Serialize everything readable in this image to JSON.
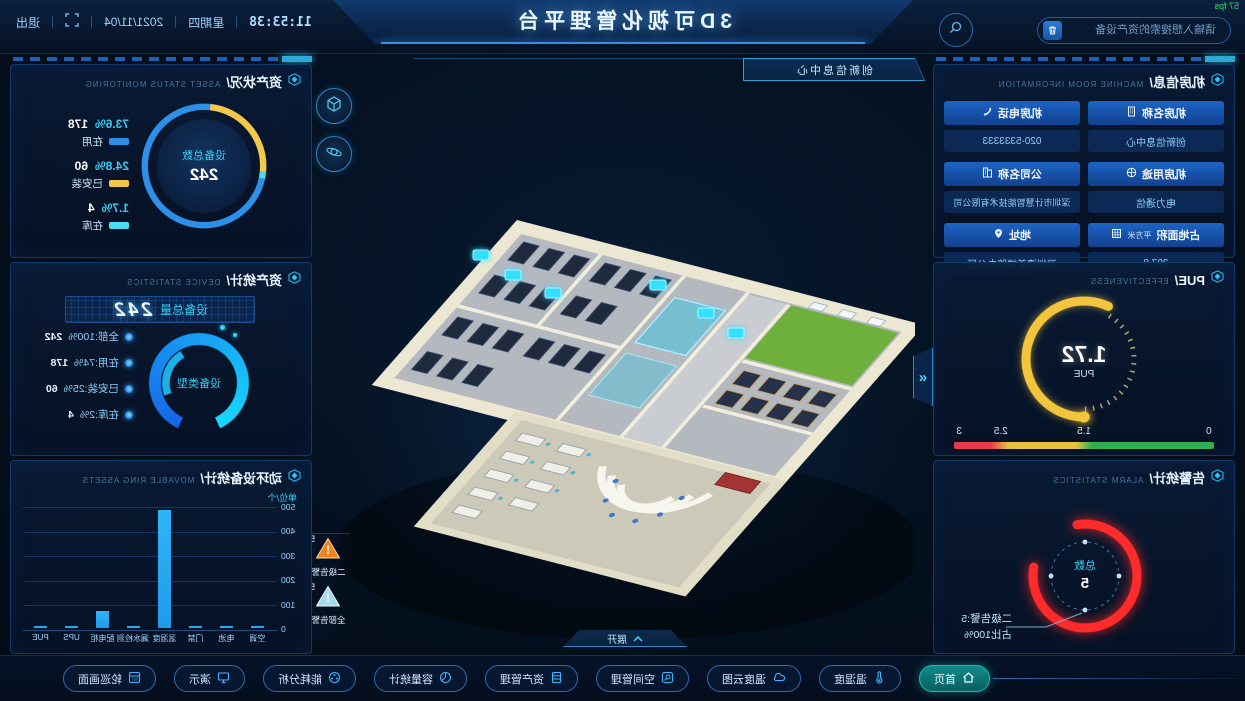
{
  "fps": "57 fps",
  "colors": {
    "accent_cyan": "#27c5f5",
    "blue": "#2e8fe8",
    "yellow": "#f3c84b",
    "light_cyan": "#4adcf0",
    "red": "#ff2b2b",
    "green": "#2fae52",
    "orange": "#f08220",
    "badge_blue": "#a8d8f0",
    "bar_blue": "#1e9be8"
  },
  "top_bar": {
    "title": "3D可视化管理平台",
    "search_placeholder": "请输入想搜索的资产设备",
    "time": "11:53:38",
    "weekday": "星期四",
    "date": "2021/11/04",
    "exit_label": "退出"
  },
  "left_column": {
    "room_info": {
      "title": "机房信息/",
      "subtitle": "MACHINE ROOM INFORMATION",
      "col1": [
        {
          "label": "机房名称",
          "value": "创新信息中心",
          "icon": "building-icon"
        },
        {
          "label": "机房用途",
          "value": "电力通信",
          "icon": "wheel-icon"
        },
        {
          "label": "占地面积",
          "unit": "平方米",
          "value": "297.8",
          "icon": "area-icon"
        }
      ],
      "col2": [
        {
          "label": "机房电话",
          "value": "020-5333333",
          "icon": "phone-icon"
        },
        {
          "label": "公司名称",
          "value": "深圳市计慧智能技术有限公司",
          "icon": "company-icon"
        },
        {
          "label": "地址",
          "value": "深圳湾美福路办公区",
          "icon": "pin-icon"
        }
      ]
    },
    "pue": {
      "title": "PUE/",
      "subtitle": "EFFECTIVENESS",
      "value": "1.72",
      "unit": "PUE",
      "ticks": [
        "0",
        "1.5",
        "2.5",
        "3"
      ],
      "gauge_min": 0,
      "gauge_max": 3
    },
    "alarm": {
      "title": "告警统计/",
      "subtitle": "ALARM STATISTICS",
      "center_label": "总数",
      "center_value": "5",
      "callout1": "二级告警:5",
      "callout2": "占比100%"
    }
  },
  "center": {
    "scene_tag": "创新信息中心",
    "expand_label": "展开",
    "badges": [
      {
        "count": "5",
        "label": "二级告警",
        "severity": "level2-orange"
      },
      {
        "count": "5",
        "label": "全部告警",
        "severity": "all-blue"
      }
    ]
  },
  "right_column": {
    "asset_status": {
      "title": "资产状况/",
      "subtitle": "ASSET STATUS MONITORING",
      "center_label": "设备总数",
      "center_value": "242",
      "legend": [
        {
          "percent": "73.6%",
          "count": "178",
          "label": "在用",
          "color": "#2e8fe8"
        },
        {
          "percent": "24.8%",
          "count": "60",
          "label": "已安装",
          "color": "#f3c84b"
        },
        {
          "percent": "1.7%",
          "count": "4",
          "label": "在库",
          "color": "#4adcf0"
        }
      ]
    },
    "device_stats": {
      "title": "资产统计/",
      "subtitle": "DEVICE STATISTICS",
      "lcd_label": "设备总量",
      "lcd_value": "242",
      "ring_label": "设备类型",
      "legend": [
        {
          "label": "全部:100%",
          "count": "242"
        },
        {
          "label": "在用:74%",
          "count": "178"
        },
        {
          "label": "已安装:25%",
          "count": "60"
        },
        {
          "label": "在库:2%",
          "count": "4"
        }
      ]
    },
    "ring_assets": {
      "title": "动环设备统计/",
      "subtitle": "MOVABLE RING ASSETS",
      "unit": "单位/个"
    }
  },
  "chart_data": {
    "type": "bar",
    "title": "动环设备统计",
    "categories": [
      "空调",
      "电池",
      "门禁",
      "温湿度",
      "漏水检测",
      "配电柜",
      "UPS",
      "PUE"
    ],
    "values": [
      10,
      4,
      6,
      480,
      8,
      70,
      5,
      3
    ],
    "yticks": [
      "500",
      "400",
      "300",
      "200",
      "100",
      "0"
    ],
    "ylim": [
      0,
      500
    ],
    "ylabel": "单位/个",
    "bar_color": "#1e9be8",
    "grid": true,
    "legend_position": "none"
  },
  "toolbar": {
    "buttons": [
      {
        "label": "首页",
        "icon": "home-icon",
        "active": true
      },
      {
        "label": "温湿度",
        "icon": "thermometer-icon",
        "active": false
      },
      {
        "label": "温度云图",
        "icon": "cloud-icon",
        "active": false
      },
      {
        "label": "空间管理",
        "icon": "search-box-icon",
        "active": false
      },
      {
        "label": "资产管理",
        "icon": "cabinet-icon",
        "active": false
      },
      {
        "label": "容量统计",
        "icon": "pie-icon",
        "active": false
      },
      {
        "label": "能耗分析",
        "icon": "reel-icon",
        "active": false
      },
      {
        "label": "演示",
        "icon": "presentation-icon",
        "active": false
      },
      {
        "label": "轮巡画面",
        "icon": "monitor-keyboard-icon",
        "active": false
      }
    ]
  }
}
